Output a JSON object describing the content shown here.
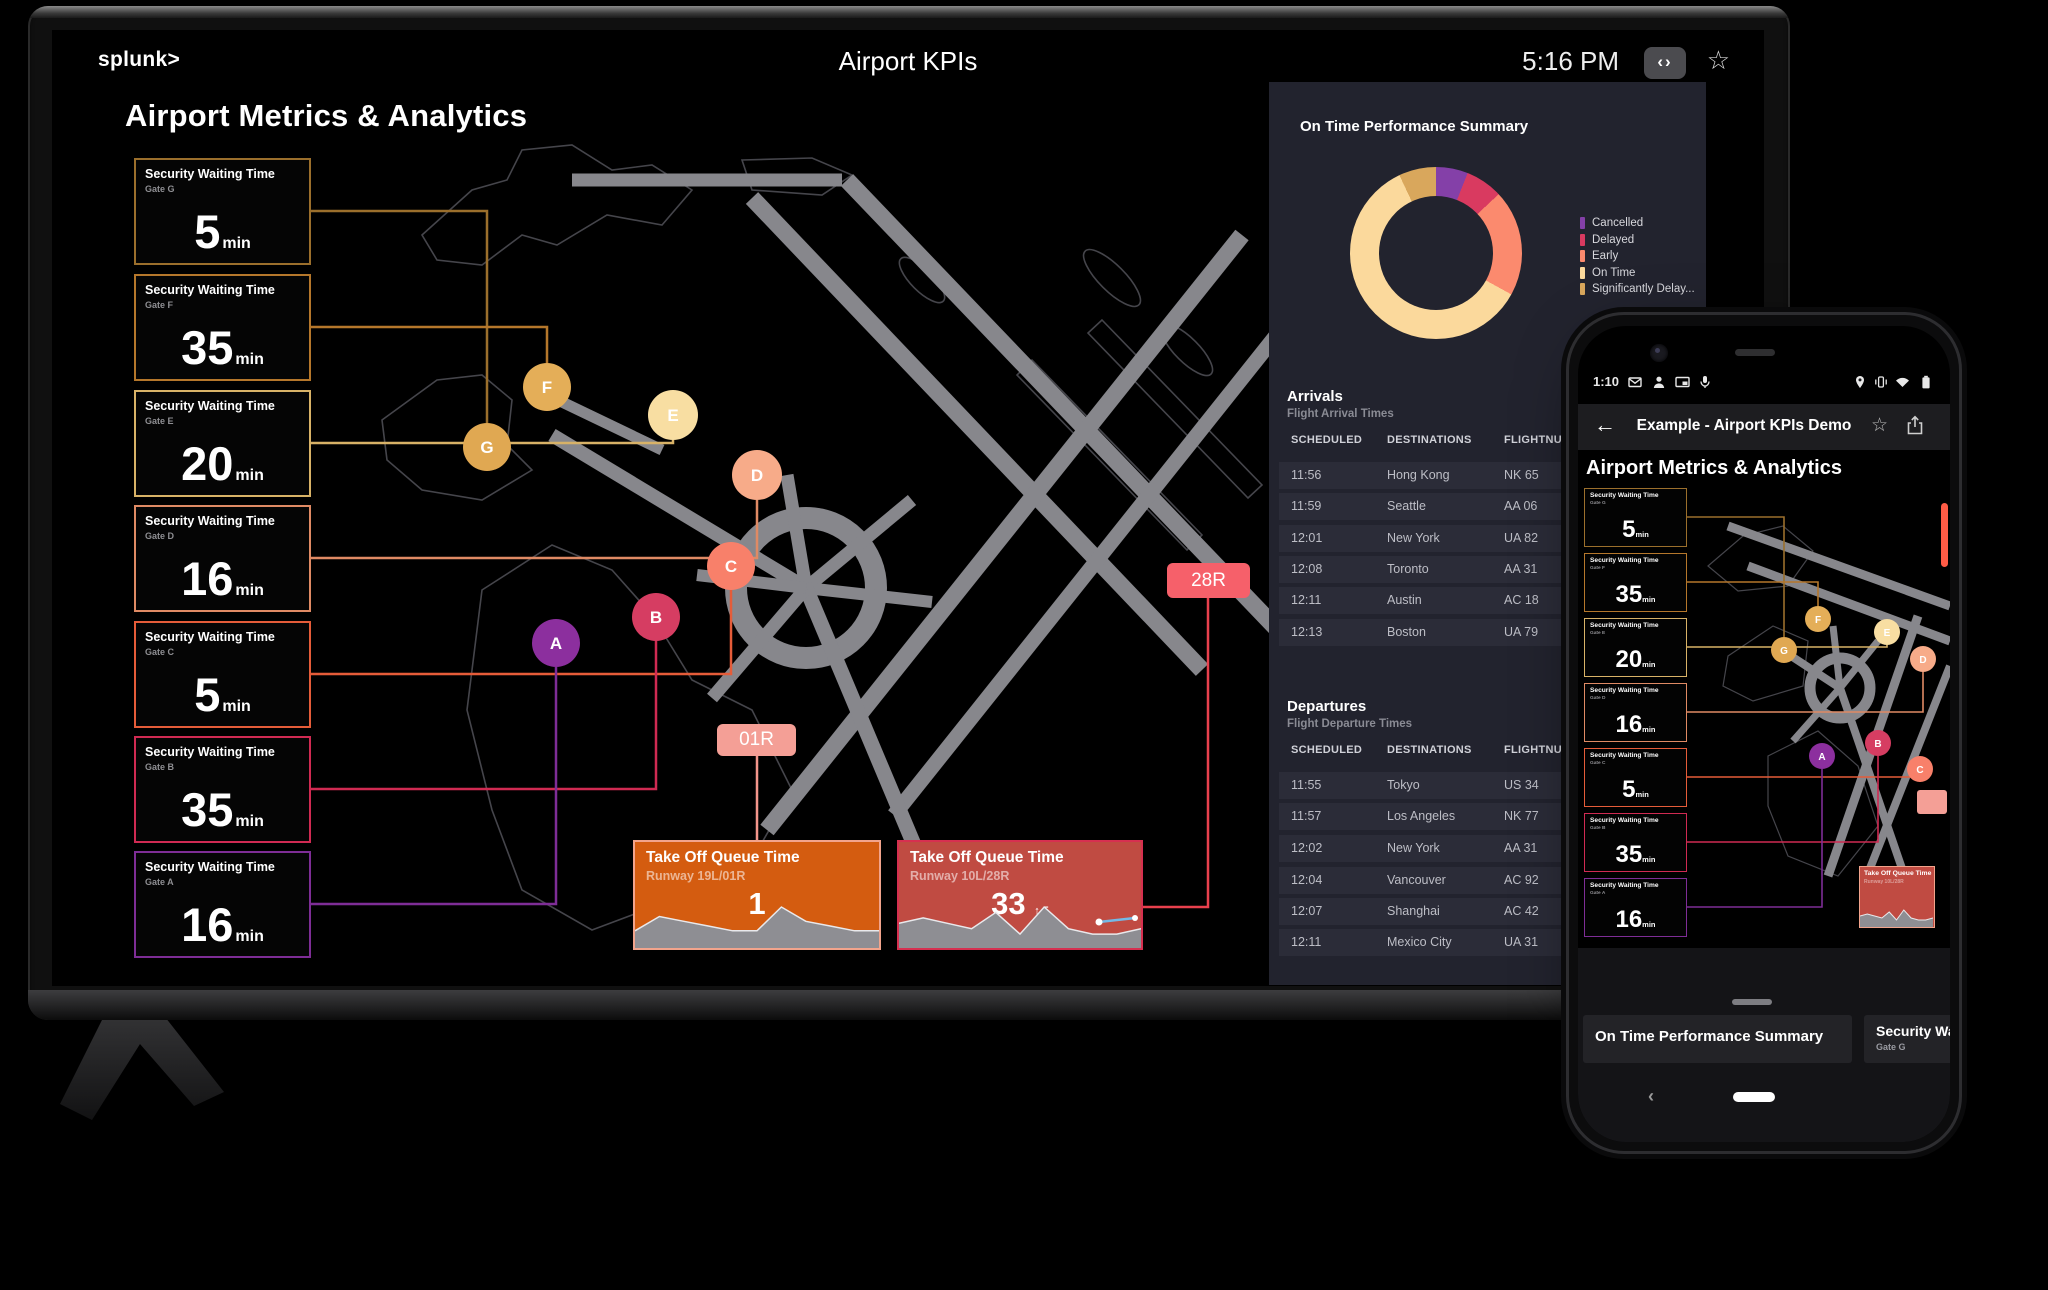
{
  "tv": {
    "topbar": {
      "logo": "splunk>",
      "title": "Airport KPIs",
      "time": "5:16 PM",
      "code_button": "‹›",
      "star": "☆"
    },
    "heading": "Airport Metrics & Analytics",
    "security_cards": [
      {
        "title": "Security Waiting Time",
        "gate": "Gate G",
        "value": "5",
        "unit": "min",
        "letter": "G",
        "border": "#9b6f2c",
        "circle": "#e0a852"
      },
      {
        "title": "Security Waiting Time",
        "gate": "Gate F",
        "value": "35",
        "unit": "min",
        "letter": "F",
        "border": "#b5772b",
        "circle": "#e4ae58"
      },
      {
        "title": "Security Waiting Time",
        "gate": "Gate E",
        "value": "20",
        "unit": "min",
        "letter": "E",
        "border": "#d8b267",
        "circle": "#f8dea2"
      },
      {
        "title": "Security Waiting Time",
        "gate": "Gate D",
        "value": "16",
        "unit": "min",
        "letter": "D",
        "border": "#df8a64",
        "circle": "#f7ab89"
      },
      {
        "title": "Security Waiting Time",
        "gate": "Gate C",
        "value": "5",
        "unit": "min",
        "letter": "C",
        "border": "#e55c39",
        "circle": "#f8806a"
      },
      {
        "title": "Security Waiting Time",
        "gate": "Gate B",
        "value": "35",
        "unit": "min",
        "letter": "B",
        "border": "#d02a52",
        "circle": "#d63d62"
      },
      {
        "title": "Security Waiting Time",
        "gate": "Gate A",
        "value": "16",
        "unit": "min",
        "letter": "A",
        "border": "#7e2d96",
        "circle": "#8c2f9e"
      }
    ],
    "map": {
      "runway_labels": [
        {
          "text": "01R",
          "bg": "#f49f96",
          "line": "#f2958b"
        },
        {
          "text": "28R",
          "bg": "#f6606a",
          "line": "#e8404d"
        }
      ]
    },
    "takeoff_cards": [
      {
        "title": "Take Off Queue Time",
        "subtitle": "Runway 19L/01R",
        "value": "1",
        "trend": "",
        "bg": "#d45c10",
        "border": "#f2a48c"
      },
      {
        "title": "Take Off Queue Time",
        "subtitle": "Runway 10L/28R",
        "value": "33",
        "trend": "↑ 5",
        "bg": "#c04b42",
        "border": "#d63050"
      }
    ],
    "panel": {
      "ontime_title": "On Time Performance Summary",
      "legend": [
        {
          "label": "Cancelled",
          "color": "#8440a8"
        },
        {
          "label": "Delayed",
          "color": "#d93a60"
        },
        {
          "label": "Early",
          "color": "#fb8a6e"
        },
        {
          "label": "On Time",
          "color": "#fbd99c"
        },
        {
          "label": "Significantly Delay...",
          "color": "#d9a75c"
        }
      ],
      "arrivals": {
        "title": "Arrivals",
        "subtitle": "Flight Arrival Times",
        "headers": [
          "SCHEDULED",
          "DESTINATIONS",
          "FLIGHTNUMBER"
        ],
        "rows": [
          [
            "11:56",
            "Hong Kong",
            "NK 65"
          ],
          [
            "11:59",
            "Seattle",
            "AA 06"
          ],
          [
            "12:01",
            "New York",
            "UA 82"
          ],
          [
            "12:08",
            "Toronto",
            "AA 31"
          ],
          [
            "12:11",
            "Austin",
            "AC 18"
          ],
          [
            "12:13",
            "Boston",
            "UA 79"
          ]
        ]
      },
      "departures": {
        "title": "Departures",
        "subtitle": "Flight Departure Times",
        "headers": [
          "SCHEDULED",
          "DESTINATIONS",
          "FLIGHTNUMBER"
        ],
        "rows": [
          [
            "11:55",
            "Tokyo",
            "US 34"
          ],
          [
            "11:57",
            "Los Angeles",
            "NK 77"
          ],
          [
            "12:02",
            "New York",
            "AA 31"
          ],
          [
            "12:04",
            "Vancouver",
            "AC 92"
          ],
          [
            "12:07",
            "Shanghai",
            "AC 42"
          ],
          [
            "12:11",
            "Mexico City",
            "UA 31"
          ]
        ]
      }
    }
  },
  "phone": {
    "statusbar": {
      "time": "1:10"
    },
    "appbar": {
      "back": "←",
      "title": "Example - Airport KPIs Demo",
      "star": "☆"
    },
    "heading": "Airport Metrics & Analytics",
    "sheet": {
      "cards": [
        {
          "title": "On Time Performance Summary"
        },
        {
          "title": "Security Waiting Time",
          "subtitle": "Gate G"
        }
      ]
    },
    "nav": {
      "back": "‹"
    }
  },
  "chart_data": [
    {
      "type": "pie",
      "donut": true,
      "title": "On Time Performance Summary",
      "legend_position": "right",
      "segments": [
        {
          "label": "Cancelled",
          "value": 6,
          "color": "#8440a8"
        },
        {
          "label": "Delayed",
          "value": 7,
          "color": "#d93a60"
        },
        {
          "label": "Early",
          "value": 20,
          "color": "#fb8a6e"
        },
        {
          "label": "On Time",
          "value": 60,
          "color": "#fbd99c"
        },
        {
          "label": "Significantly Delayed",
          "value": 7,
          "color": "#d9a75c"
        }
      ]
    },
    {
      "type": "area",
      "title": "Take Off Queue Time - Runway 19L/01R",
      "current": 1,
      "values": [
        3,
        6,
        5,
        4,
        3,
        3,
        8,
        5,
        4,
        3,
        3
      ]
    },
    {
      "type": "area",
      "title": "Take Off Queue Time - Runway 10L/28R",
      "current": 33,
      "trend": "+5",
      "values": [
        4,
        5,
        4,
        3,
        6,
        2,
        7,
        3,
        2,
        2,
        3
      ]
    }
  ]
}
